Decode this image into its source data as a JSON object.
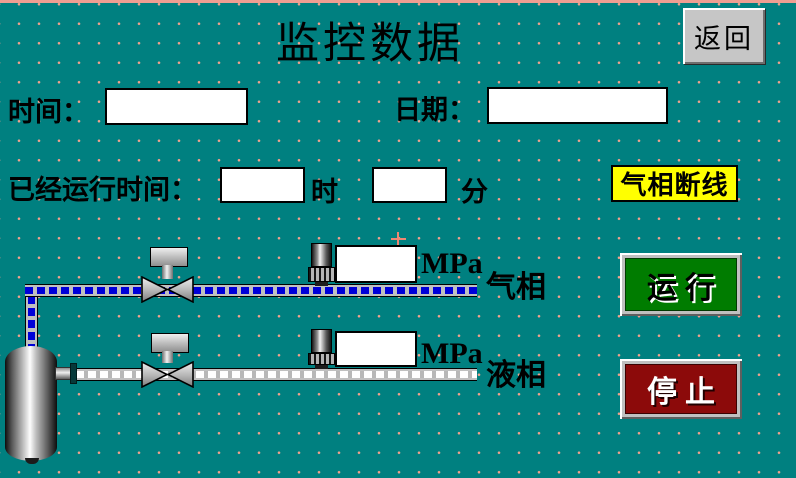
{
  "title": "监控数据",
  "back_button": {
    "label": "返回"
  },
  "clock": {
    "time_label": "时间：",
    "time_value": "",
    "date_label": "日期：",
    "date_value": ""
  },
  "runtime": {
    "label": "已经运行时间：",
    "hours_value": "",
    "hours_unit": "时",
    "minutes_value": "",
    "minutes_unit": "分"
  },
  "alarm": {
    "label": "气相断线"
  },
  "gas_line": {
    "label": "气相",
    "pressure_value": "",
    "pressure_unit": "MPa"
  },
  "liquid_line": {
    "label": "液相",
    "pressure_value": "",
    "pressure_unit": "MPa"
  },
  "controls": {
    "run_label": "运行",
    "stop_label": "停止"
  },
  "colors": {
    "background": "#008080",
    "grid_dot": "#f0a28e",
    "top_border": "#ef9e92",
    "alarm_bg": "#ffff00",
    "run_bg": "#007c00",
    "stop_bg": "#8c0a0a",
    "gas_pipe_dash": "#0000d8",
    "liquid_pipe_dash": "#ffffff",
    "button_face": "#c6c6c6"
  }
}
